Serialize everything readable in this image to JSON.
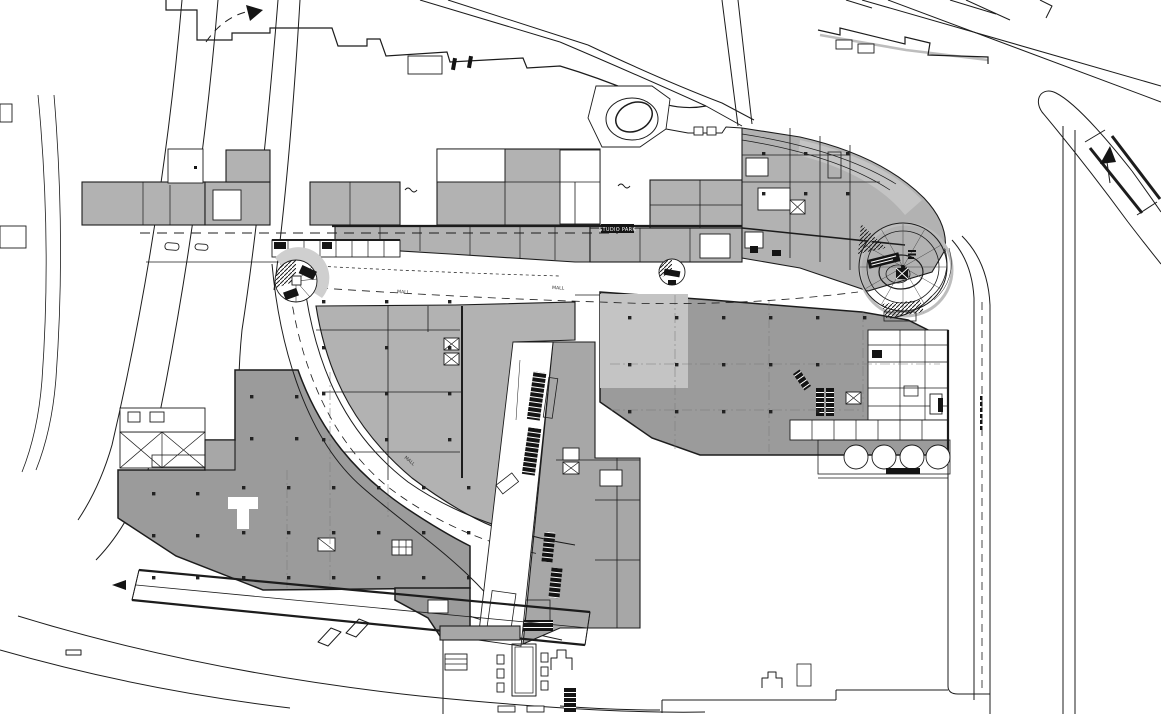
{
  "plan": {
    "labels": {
      "studio_park": "STUDIO PARK",
      "mall": "MALL"
    },
    "colors": {
      "line": "#1c1c1c",
      "paper": "#ffffff",
      "building_light": "#b2b2b2",
      "building_mid": "#a7a7a7",
      "building_dark": "#9b9b9b",
      "building_pale": "#c4c4c4",
      "shadow": "#bdbdbd"
    }
  }
}
